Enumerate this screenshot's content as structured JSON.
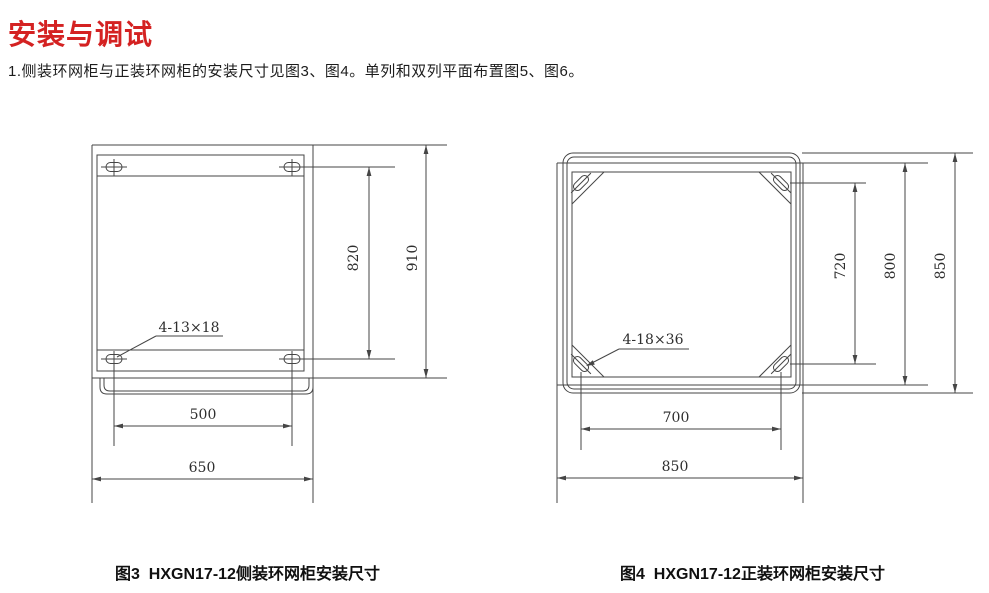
{
  "page": {
    "title": "安装与调试",
    "intro": "1.侧装环网柜与正装环网柜的安装尺寸见图3、图4。单列和双列平面布置图5、图6。",
    "title_color": "#d42222",
    "line_color": "#454545"
  },
  "figure3": {
    "caption": "图3  HXGN17-12侧装环网柜安装尺寸",
    "hole_label": "4-13×18",
    "dim_slot_span_vertical": "820",
    "dim_overall_height": "910",
    "dim_slot_span_horizontal": "500",
    "dim_overall_width": "650"
  },
  "figure4": {
    "caption": "图4  HXGN17-12正装环网柜安装尺寸",
    "hole_label": "4-18×36",
    "dim_slot_span_vertical": "720",
    "dim_frame_depth": "800",
    "dim_overall_depth": "850",
    "dim_slot_span_horizontal": "700",
    "dim_overall_width": "850"
  }
}
